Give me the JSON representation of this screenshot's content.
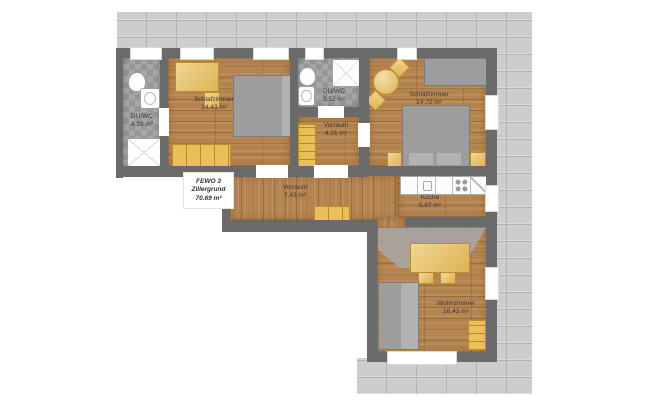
{
  "plan": {
    "unit": {
      "name": "FEWO 3",
      "location": "Zillergrund",
      "total_area": "70.69 m²"
    },
    "rooms": {
      "duwc_left": {
        "name": "DU/WC",
        "area": "4.28 m²"
      },
      "schlafzimmer_left": {
        "name": "Schlafzimmer",
        "area": "14.43 m²"
      },
      "duwc_small": {
        "name": "DU/WC",
        "area": "3.52 m²"
      },
      "vorraum_small": {
        "name": "Vorraum",
        "area": "4.01 m²"
      },
      "schlafzimmer_right": {
        "name": "Schlafzimmer",
        "area": "14.72 m²"
      },
      "vorraum_main": {
        "name": "Vorraum",
        "area": "7.43 m²"
      },
      "kueche": {
        "name": "Küche",
        "area": "5.87 m²"
      },
      "wohnzimmer": {
        "name": "Wohnzimmer",
        "area": "16.43 m²"
      }
    },
    "furniture_symbols": {
      "schlafzimmer_left": [
        "desk",
        "chair",
        "double-bed",
        "dresser"
      ],
      "duwc_left": [
        "toilet",
        "washbasin",
        "shower"
      ],
      "duwc_small": [
        "toilet",
        "washbasin",
        "shower"
      ],
      "vorraum_small": [
        "wardrobe"
      ],
      "schlafzimmer_right": [
        "round-table",
        "chairs",
        "wardrobe",
        "double-bed",
        "nightstands"
      ],
      "vorraum_main": [
        "sideboard"
      ],
      "kueche": [
        "kitchen-counter",
        "sink",
        "stove"
      ],
      "wohnzimmer": [
        "dining-table",
        "chairs",
        "sofa",
        "cabinet"
      ]
    },
    "colors": {
      "wall": "#6a6a6a",
      "stone_facade": "#cdcdcd",
      "wood_floor": "#b5834e",
      "tile_floor": "#a0a0a0",
      "furniture": "#eabf5a",
      "bed_gray": "#9d9d9d",
      "background": "#ffffff"
    }
  }
}
